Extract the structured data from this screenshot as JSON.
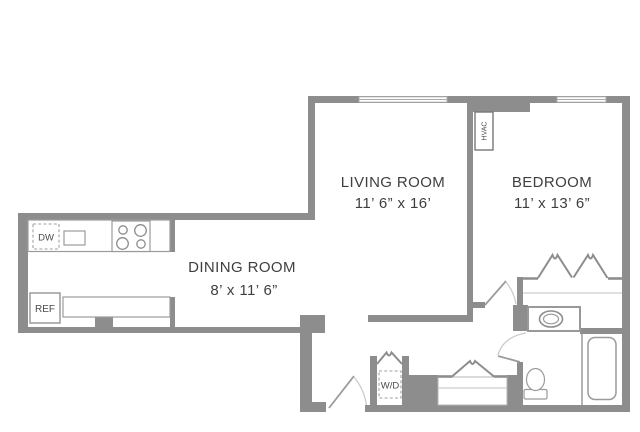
{
  "floorplan": {
    "rooms": {
      "living": {
        "name": "LIVING ROOM",
        "dims": "11’ 6” x 16’"
      },
      "bedroom": {
        "name": "BEDROOM",
        "dims": "11’ x 13’ 6”"
      },
      "dining": {
        "name": "DINING ROOM",
        "dims": "8’ x 11’ 6”"
      }
    },
    "labels": {
      "dishwasher": "DW",
      "refrigerator": "REF",
      "washer_dryer": "W/D",
      "hvac": "HVAC"
    },
    "colors": {
      "wall": "#8d8d8d",
      "fixture_line": "#9b9b9b",
      "door_arc": "#cccccc",
      "text": "#3f3f3f",
      "background": "#ffffff"
    }
  }
}
